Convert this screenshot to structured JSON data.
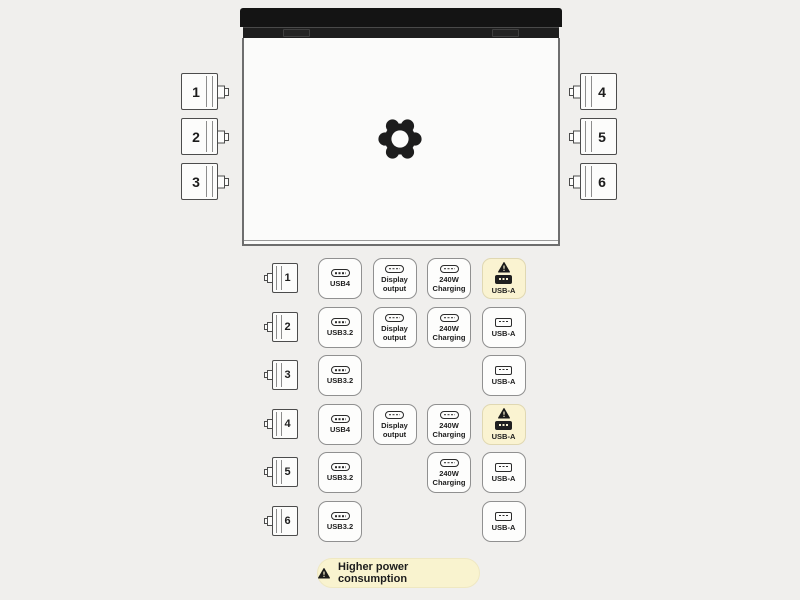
{
  "laptop": {
    "logo_icon": "framework-gear-logo",
    "hinge_segments": 2
  },
  "side_ports": {
    "left": [
      {
        "num": "1"
      },
      {
        "num": "2"
      },
      {
        "num": "3"
      }
    ],
    "right": [
      {
        "num": "4"
      },
      {
        "num": "5"
      },
      {
        "num": "6"
      }
    ]
  },
  "port_rows": [
    {
      "port": "1",
      "cells": [
        {
          "col": 0,
          "icon": "usb-c",
          "label": "USB4",
          "warning": false
        },
        {
          "col": 1,
          "icon": "usb-c",
          "label": "Display output",
          "warning": false
        },
        {
          "col": 2,
          "icon": "usb-c",
          "label": "240W Charging",
          "warning": false
        },
        {
          "col": 3,
          "icon": "usb-a",
          "label": "USB-A",
          "warning": true
        }
      ]
    },
    {
      "port": "2",
      "cells": [
        {
          "col": 0,
          "icon": "usb-c",
          "label": "USB3.2",
          "warning": false
        },
        {
          "col": 1,
          "icon": "usb-c",
          "label": "Display output",
          "warning": false
        },
        {
          "col": 2,
          "icon": "usb-c",
          "label": "240W Charging",
          "warning": false
        },
        {
          "col": 3,
          "icon": "usb-a",
          "label": "USB-A",
          "warning": false
        }
      ]
    },
    {
      "port": "3",
      "cells": [
        {
          "col": 0,
          "icon": "usb-c",
          "label": "USB3.2",
          "warning": false
        },
        {
          "col": 3,
          "icon": "usb-a",
          "label": "USB-A",
          "warning": false
        }
      ]
    },
    {
      "port": "4",
      "cells": [
        {
          "col": 0,
          "icon": "usb-c",
          "label": "USB4",
          "warning": false
        },
        {
          "col": 1,
          "icon": "usb-c",
          "label": "Display output",
          "warning": false
        },
        {
          "col": 2,
          "icon": "usb-c",
          "label": "240W Charging",
          "warning": false
        },
        {
          "col": 3,
          "icon": "usb-a",
          "label": "USB-A",
          "warning": true
        }
      ]
    },
    {
      "port": "5",
      "cells": [
        {
          "col": 0,
          "icon": "usb-c",
          "label": "USB3.2",
          "warning": false
        },
        {
          "col": 2,
          "icon": "usb-c",
          "label": "240W Charging",
          "warning": false
        },
        {
          "col": 3,
          "icon": "usb-a",
          "label": "USB-A",
          "warning": false
        }
      ]
    },
    {
      "port": "6",
      "cells": [
        {
          "col": 0,
          "icon": "usb-c",
          "label": "USB3.2",
          "warning": false
        },
        {
          "col": 3,
          "icon": "usb-a",
          "label": "USB-A",
          "warning": false
        }
      ]
    }
  ],
  "legend": {
    "warning_icon": "warning-triangle-icon",
    "label": "Higher power consumption"
  },
  "colors": {
    "page_bg": "#f0efed",
    "laptop_dark": "#141414",
    "warning_bg": "#faf3d1",
    "badge_border": "#909090",
    "text_dark": "#1c1c1c"
  }
}
